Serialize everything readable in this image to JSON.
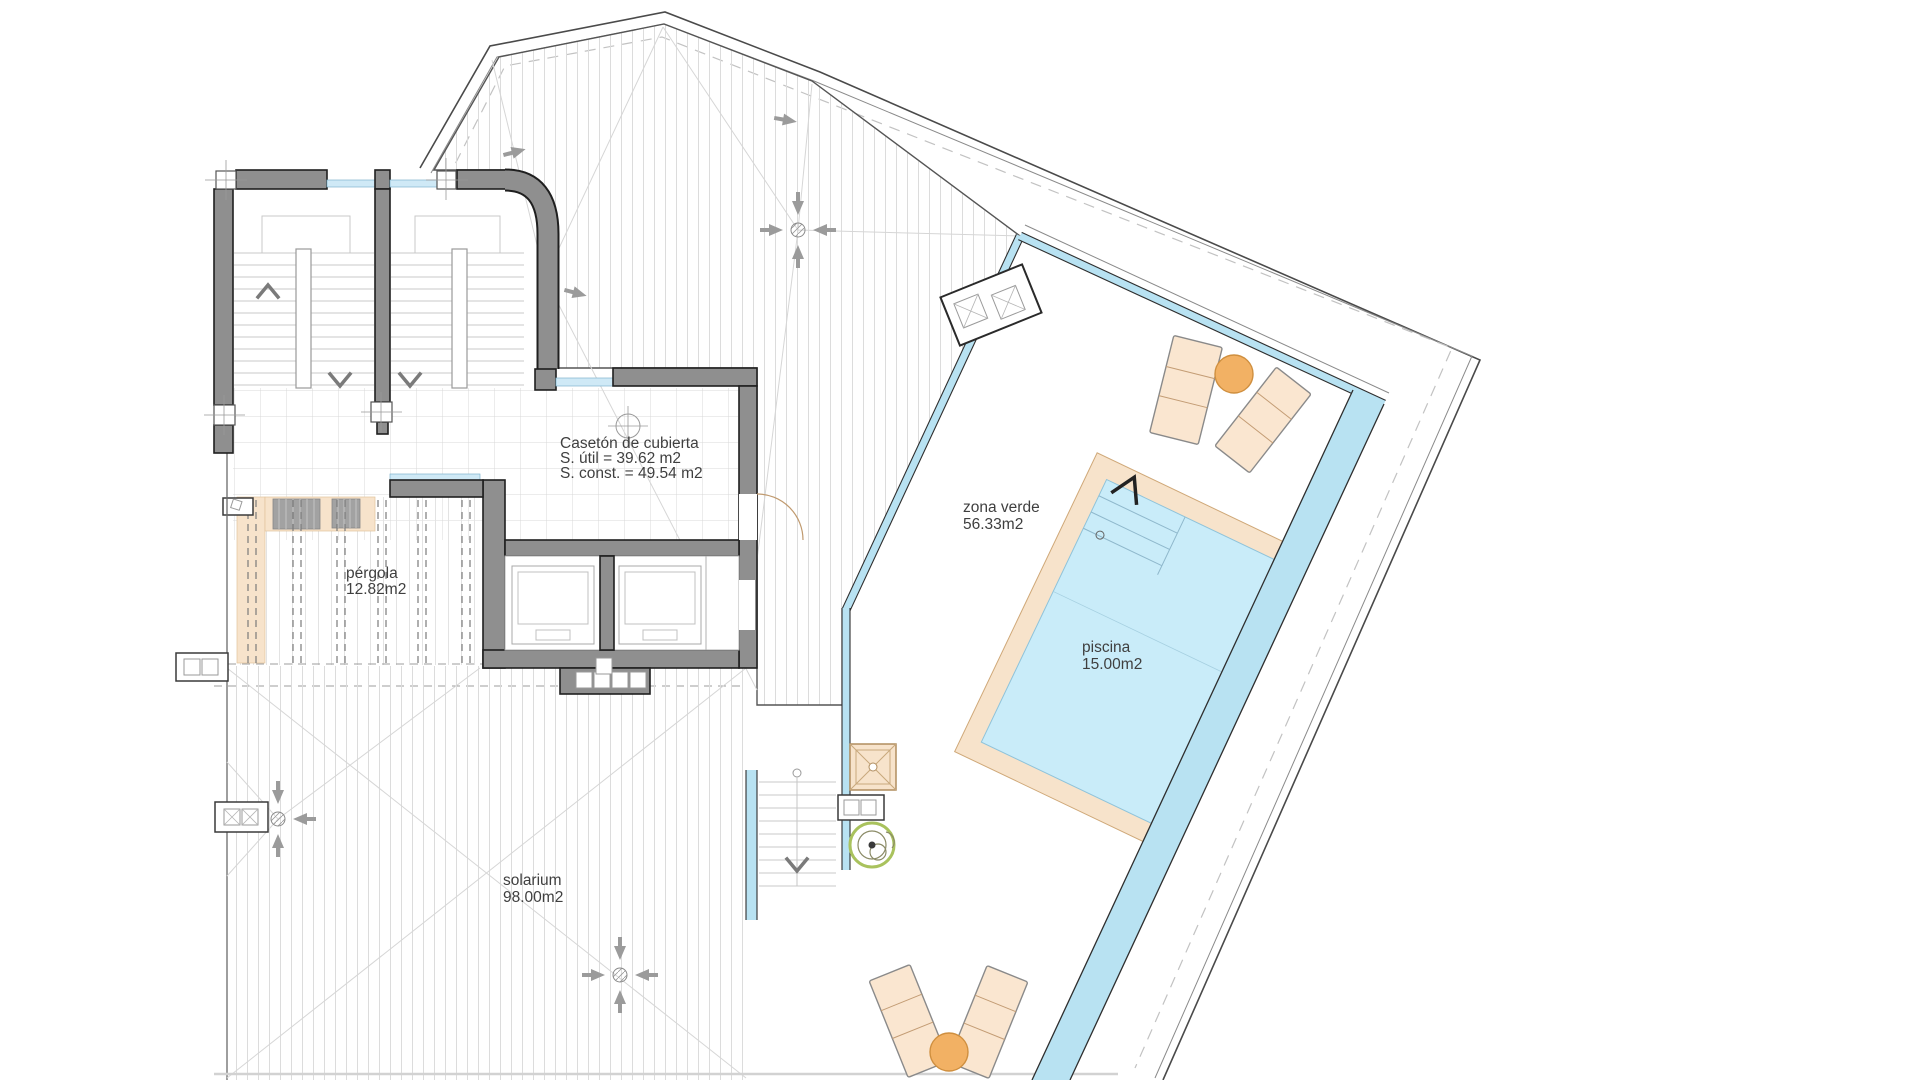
{
  "plan": {
    "caseton": {
      "title": "Casetón de cubierta",
      "line_util": "S. útil = 39.62 m2",
      "line_const": "S. const. = 49.54 m2"
    },
    "pergola": {
      "name": "pérgola",
      "area": "12.82m2"
    },
    "solarium": {
      "name": "solarium",
      "area": "98.00m2"
    },
    "zona_verde": {
      "name": "zona verde",
      "area": "56.33m2"
    },
    "piscina": {
      "name": "piscina",
      "area": "15.00m2"
    }
  },
  "colors": {
    "background": "#ffffff",
    "wall": "#8f8f8f",
    "wall_outline": "#1f1f1f",
    "glass": "#b8e2f2",
    "water": "#c9ecf9",
    "coping": "#f7e3cb",
    "lounger": "#fae6d0",
    "lounger_border": "#8a8a8a",
    "table": "#f2b164",
    "plant": "#a9c25d",
    "text": "#3f3f3f",
    "drain_arrow": "#9b9b9b"
  }
}
